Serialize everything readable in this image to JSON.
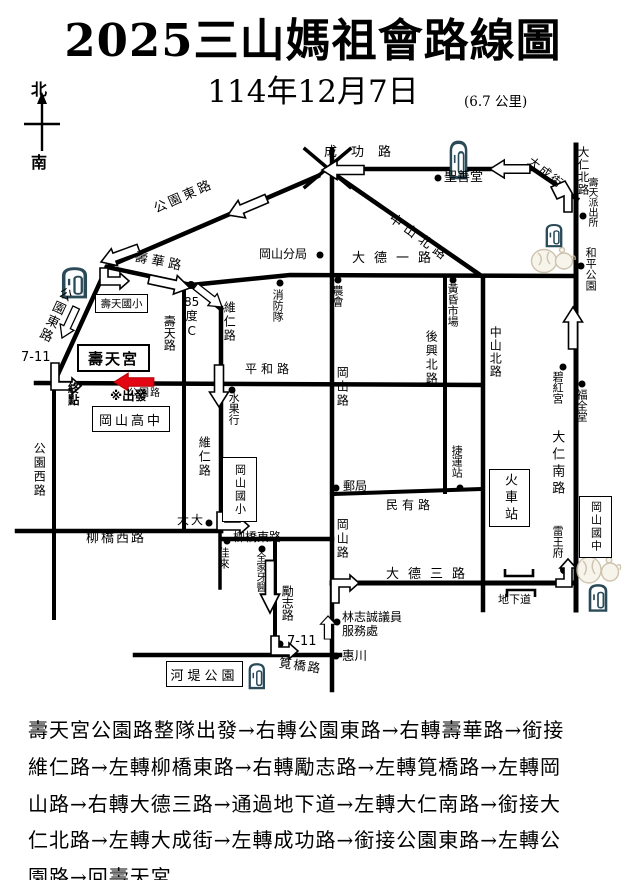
{
  "header": {
    "title": "2025三山媽祖會路線圖",
    "date": "114年12月7日",
    "distance": "(6.7 公里)",
    "compass_north": "北",
    "compass_south": "南"
  },
  "map": {
    "labels": {
      "gongyuan_dong_1": "公園東路",
      "gongyuan_dong_2": "公園東路",
      "shouhua_rd": "壽華路",
      "chenggong_rd": "成功路",
      "shengshantang": "聖善堂",
      "dacheng_st": "大成街",
      "daren_n_rd": "大仁北路",
      "shoutian_police": "壽天派出所",
      "heping_park": "和平公園",
      "zhongshan_n_1": "中山北路",
      "zhongshan_n_2": "中山北路",
      "gangshan_branch": "岡山分局",
      "dade_1_rd": "大德一路",
      "nonghui": "農會",
      "fire_brigade": "消防隊",
      "market": "黃昏市場",
      "houxing_n_rd": "後興北路",
      "bihong_temple": "碧紅宮",
      "fuquan_tang": "福全堂",
      "daren_s_rd": "大仁南路",
      "mrt_station": "捷運站",
      "train_station": "火車站",
      "gangshan_jhs": "岡山國中",
      "leiwang_fu": "雷王府",
      "underpass": "地下道",
      "dade_3_rd": "大德三路",
      "minyou_rd": "民有路",
      "post_office": "郵局",
      "gangshan_rd_1": "岡山路",
      "gangshan_rd_2": "岡山路",
      "pinghe_rd": "平和路",
      "fruit_shop": "水果行",
      "weiren_rd_1": "維仁路",
      "weiren_rd_2": "維仁路",
      "shoutian_rd": "壽天路",
      "cafe_85c": "85\n度\nC",
      "seven11_w": "7-11",
      "shoutian_gong": "壽天宮",
      "end_point": "終\n點",
      "depart": "※出發",
      "gongyuan_rd": "公園路",
      "shoutian_es": "壽天國小",
      "gangshan_shs": "岡山高中",
      "gongyuan_w_rd": "公園西路",
      "liuqiao_w_rd": "柳橋西路",
      "dada": "大大",
      "gangshan_es": "岡山國小",
      "liuqiao_e_rd": "柳橋東路",
      "jialai": "佳來",
      "family_dental": "全家牙醫",
      "lizhi_rd": "勵志路",
      "councilor": "林志誠議員\n服務處",
      "seven11_s": "7-11",
      "huichuan": "惠川",
      "jianqiao_rd": "筧橋路",
      "hedi_park": "河堤公園"
    }
  },
  "route_text": "壽天宮公園路整隊出發→右轉公園東路→右轉壽華路→銜接\n維仁路→左轉柳橋東路→右轉勵志路→左轉筧橋路→左轉岡\n山路→右轉大德三路→通過地下道→左轉大仁南路→銜接大\n仁北路→左轉大成街→左轉成功路→銜接公園東路→左轉公\n園路→回壽天宮"
}
